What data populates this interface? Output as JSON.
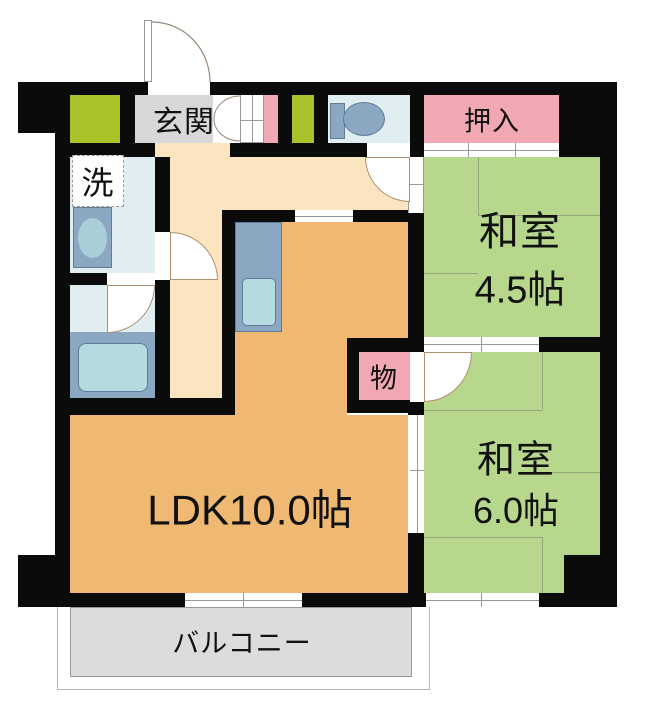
{
  "title": "apartment floor plan",
  "labels": {
    "genkan": "玄関",
    "wash": "洗",
    "toilet_room": "",
    "oshiire": "押入",
    "washitsu_45_name": "和室",
    "washitsu_45_size": "4.5帖",
    "washitsu_60_name": "和室",
    "washitsu_60_size": "6.0帖",
    "ldk": "LDK10.0帖",
    "storage": "物",
    "balcony": "バルコニー"
  },
  "fixtures": [
    {
      "name": "toilet",
      "location": "toilet-room"
    },
    {
      "name": "washbasin",
      "location": "washroom"
    },
    {
      "name": "bathtub",
      "location": "bathroom"
    },
    {
      "name": "kitchen-sink-counter",
      "location": "kitchen"
    }
  ],
  "colors": {
    "wall": "#0b0b0b",
    "tatami_room": "#b7d88c",
    "closet_pink": "#f2a8b2",
    "ldk_orange": "#f0b973",
    "hallway_peach": "#fbe5c1",
    "entry_gray": "#d8d8d8",
    "wet_floor_blue": "#e1eef1",
    "fixture_blue": "#8ba7c2",
    "water_teal": "#b5dbe0",
    "shoebox_green": "#a9c42b",
    "balcony_gray": "#dcdcdc"
  }
}
